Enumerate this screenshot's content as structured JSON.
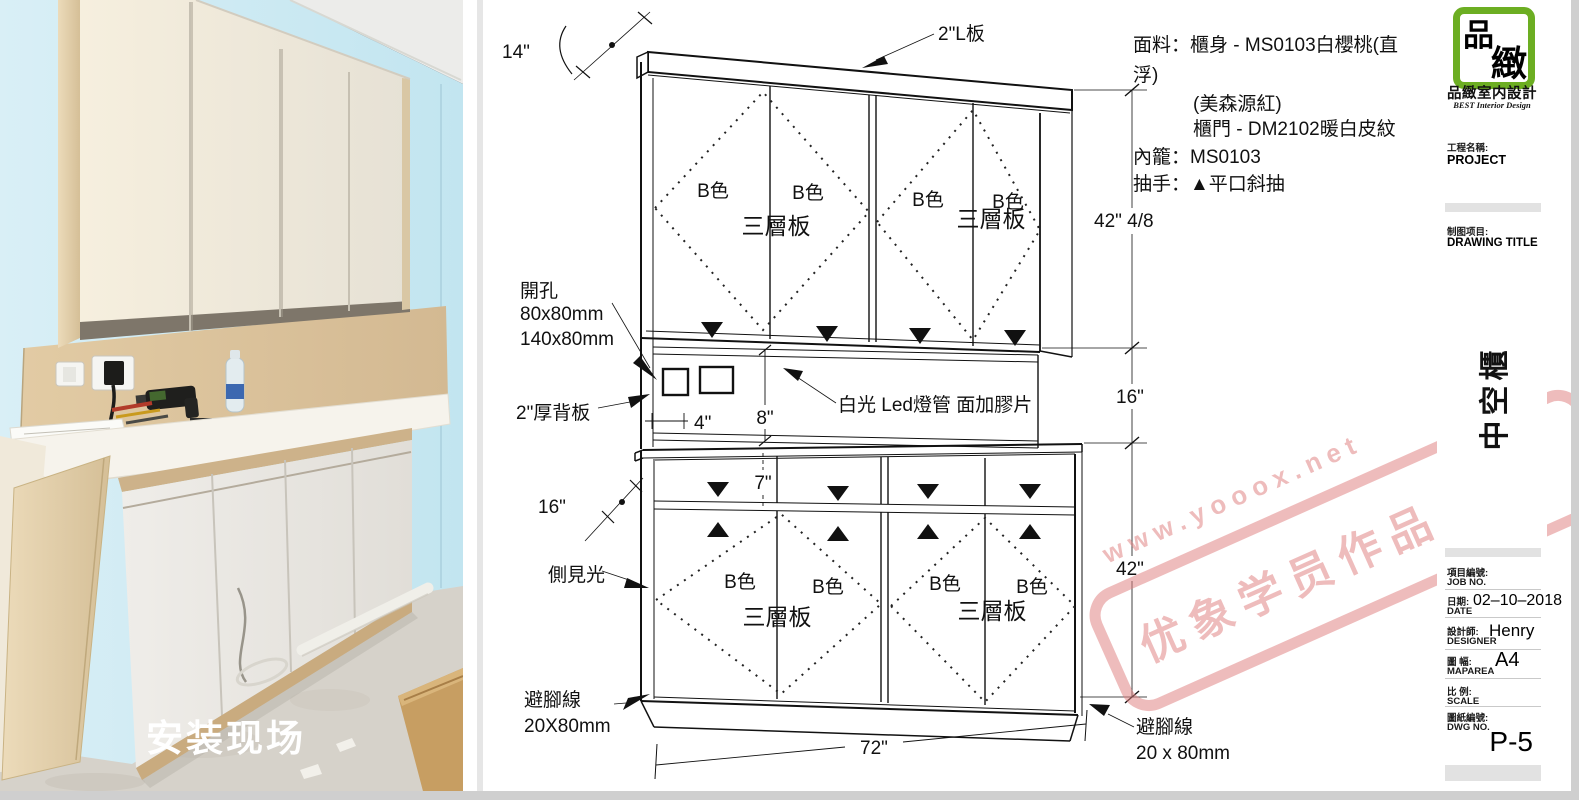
{
  "photo": {
    "caption": "安装现场"
  },
  "drawing": {
    "door_label": "B色",
    "panel_label": "三層板",
    "notes": {
      "l1": "面料：櫃身 - MS0103白櫻桃(直",
      "l2": "浮)",
      "l3": "(美森源紅)",
      "l4": "櫃門 - DM2102暖白皮紋",
      "l5": "內籠：MS0103",
      "l6": "抽手：▲平口斜抽"
    },
    "dims": {
      "top_board": "2\"L板",
      "depth_top": "14\"",
      "h_upper": "42\" 4/8",
      "h_mid": "16\"",
      "h_lower": "42\"",
      "w_total": "72\"",
      "drawer_h": "7\"",
      "hole_dx": "4\"",
      "hole_dy": "8\"",
      "depth_lower": "16\""
    },
    "callouts": {
      "holes_1": "開孔",
      "holes_2": "80x80mm",
      "holes_3": "140x80mm",
      "back_panel": "2\"厚背板",
      "led": "白光 Led燈管 面加膠片",
      "side_light": "側見光",
      "kick_left_1": "避腳線",
      "kick_left_2": "20X80mm",
      "kick_right_1": "避腳線",
      "kick_right_2": "20 x 80mm"
    }
  },
  "watermark": {
    "url": "www.yooox.net",
    "text": "优象学员作品"
  },
  "title_block": {
    "logo_char1": "品",
    "logo_char2": "緻",
    "company": "品緻室内設計",
    "tagline": "BEST Interior Design",
    "project_label_cn": "工程名稱:",
    "project_value": "PROJECT",
    "drawing_title_label_cn": "制图项目:",
    "drawing_title_value": "DRAWING TITLE",
    "drawing_name": "中空櫃",
    "job_label_cn": "項目編號:",
    "job_label_en": "JOB NO.",
    "date_label_cn": "日期:",
    "date_label_en": "DATE",
    "date_value": "02–10–2018",
    "designer_label_cn": "設計師:",
    "designer_label_en": "DESIGNER",
    "designer_value": "Henry",
    "maparea_label_cn": "圖 幅:",
    "maparea_label_en": "MAPAREA",
    "maparea_value": "A4",
    "scale_label_cn": "比 例:",
    "scale_label_en": "SCALE",
    "dwg_label_cn": "圖紙編號:",
    "dwg_label_en": "DWG NO.",
    "dwg_value": "P-5"
  }
}
